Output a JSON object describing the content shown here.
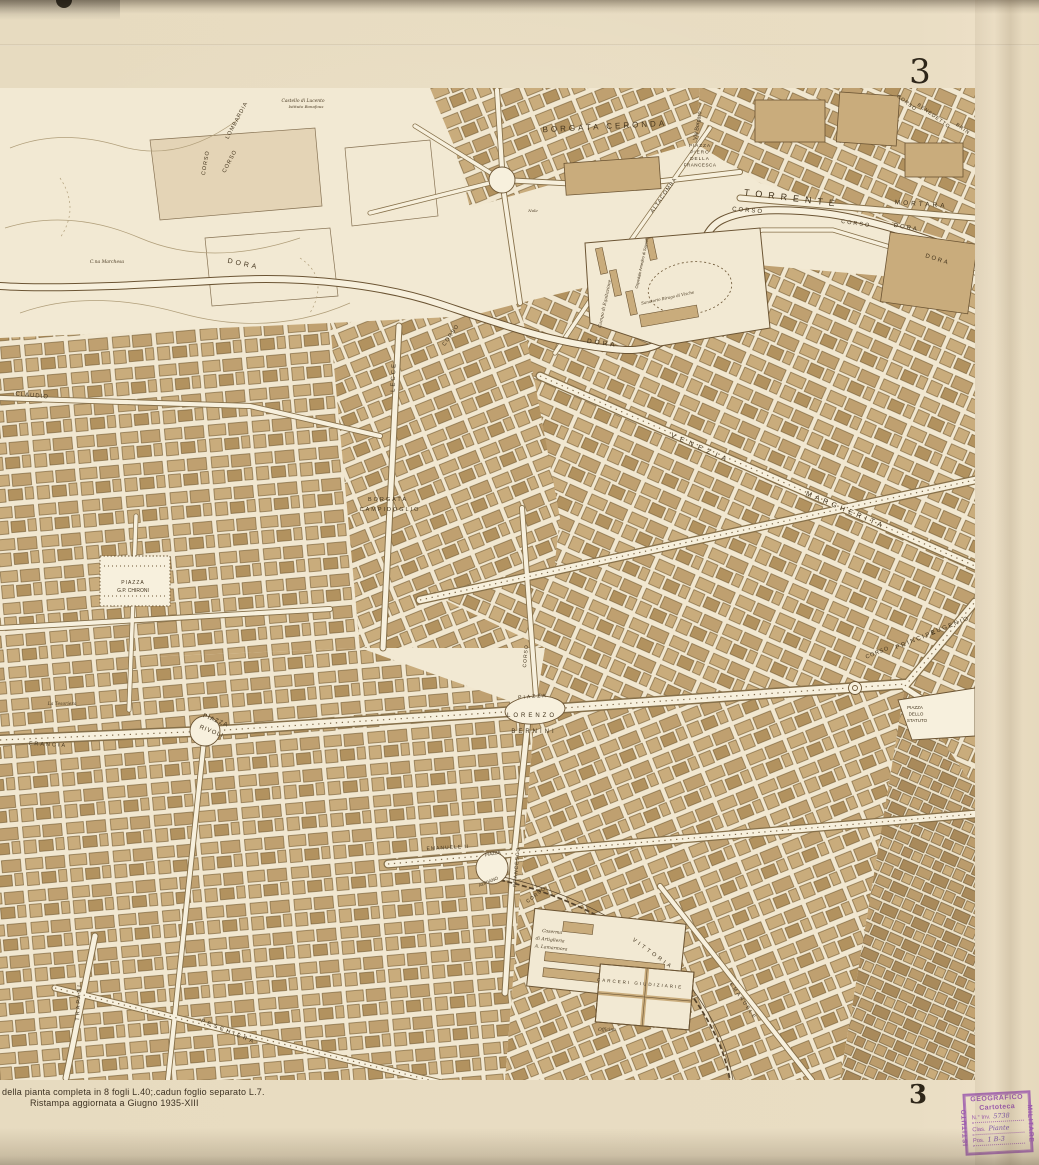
{
  "sheet": {
    "number_top": "3",
    "number_bottom": "3",
    "imprint_line1": "della pianta completa in 8 fogli L.40;.cadun foglio separato L.7.",
    "imprint_line2": "Ristampa aggiornata a Giugno 1935-XIII"
  },
  "stamp": {
    "org_top": "GEOGRAFICO",
    "org_left": "ISTITUTO",
    "org_right": "MILITARE",
    "title": "Cartoteca",
    "fields": [
      {
        "label": "N.° Inv.",
        "value": "5738"
      },
      {
        "label": "Clas.",
        "value": "Piante"
      },
      {
        "label": "Pos.",
        "value": "1 B-3"
      }
    ],
    "color": "#9b59ad"
  },
  "colors": {
    "paper": "#e8dcc2",
    "map_background": "#f2e9d3",
    "building_tan": "#c9ac7c",
    "building_dark": "#b2925f",
    "line_brown": "#6b5433",
    "label_ink": "#42331c",
    "stamp_purple": "#9b59ad"
  },
  "map": {
    "labels": [
      {
        "t": "BORGATA  CERONDA",
        "x": 605,
        "y": 41,
        "rot": -3,
        "s": 8,
        "ls": 3
      },
      {
        "t": "Via Borgaro",
        "x": 699,
        "y": 38,
        "rot": -80,
        "s": 5.5
      },
      {
        "t": "PIAZZA",
        "x": 700,
        "y": 59,
        "s": 4.6,
        "ls": 1
      },
      {
        "t": "PIERO",
        "x": 700,
        "y": 65.5,
        "s": 4.6,
        "ls": 1
      },
      {
        "t": "DELLA",
        "x": 700,
        "y": 72,
        "s": 4.6,
        "ls": 1
      },
      {
        "t": "FRANCESCA",
        "x": 700,
        "y": 78.5,
        "s": 4.6,
        "ls": 0.5
      },
      {
        "t": "TORRENTE",
        "x": 792,
        "y": 113,
        "rot": 7,
        "s": 9,
        "ls": 6
      },
      {
        "t": "CORSO",
        "x": 748,
        "y": 124,
        "rot": 5,
        "s": 6,
        "ls": 2
      },
      {
        "t": "MORTARA",
        "x": 921,
        "y": 118,
        "rot": 4,
        "s": 6.5,
        "ls": 3
      },
      {
        "t": "CORSO",
        "x": 856,
        "y": 137,
        "rot": 8,
        "s": 5.5,
        "ls": 2
      },
      {
        "t": "DORA",
        "x": 906,
        "y": 141,
        "rot": 10,
        "s": 6,
        "ls": 2
      },
      {
        "t": "DORA",
        "x": 937,
        "y": 173,
        "rot": 18,
        "s": 6,
        "ls": 2
      },
      {
        "t": "CORSO",
        "x": 906,
        "y": 16,
        "rot": 38,
        "s": 5,
        "ls": 1
      },
      {
        "t": "BENEDETTO",
        "x": 933,
        "y": 29,
        "rot": 36,
        "s": 5,
        "ls": 1
      },
      {
        "t": "BRIN",
        "x": 962,
        "y": 42,
        "rot": 36,
        "s": 5,
        "ls": 1
      },
      {
        "t": "LOMBARDIA",
        "x": 238,
        "y": 33,
        "rot": -62,
        "s": 5.5,
        "ls": 1
      },
      {
        "t": "CORSO",
        "x": 231,
        "y": 74,
        "rot": -62,
        "s": 5.5,
        "ls": 1
      },
      {
        "t": "CORSO",
        "x": 207,
        "y": 75,
        "rot": -80,
        "s": 5.5,
        "ls": 1
      },
      {
        "t": "Castello di Lucento",
        "x": 303,
        "y": 14,
        "s": 4.4,
        "i": 1
      },
      {
        "t": "Istituto Bonafous",
        "x": 306,
        "y": 20,
        "s": 4,
        "i": 1
      },
      {
        "t": "DORA",
        "x": 243,
        "y": 178,
        "rot": 12,
        "s": 7,
        "ls": 3
      },
      {
        "t": "C.na Marchesa",
        "x": 107,
        "y": 175,
        "s": 4.5,
        "i": 1
      },
      {
        "t": "CLAUDIO",
        "x": 32,
        "y": 309,
        "rot": 5,
        "s": 6,
        "ls": 1
      },
      {
        "t": "LECCE",
        "x": 395,
        "y": 289,
        "rot": -88,
        "s": 6,
        "ls": 2
      },
      {
        "t": "ALTACOMBA",
        "x": 665,
        "y": 108,
        "rot": -55,
        "s": 5.5,
        "ls": 1
      },
      {
        "t": "Nole",
        "x": 533,
        "y": 124,
        "s": 4,
        "i": 1
      },
      {
        "t": "Campo di Equitazione",
        "x": 606,
        "y": 216,
        "rot": -78,
        "s": 4.4,
        "i": 1
      },
      {
        "t": "Ospedale Amedeo di Savoia",
        "x": 643,
        "y": 176,
        "rot": -78,
        "s": 4
      },
      {
        "t": "Sanatorio Birago di Vische",
        "x": 668,
        "y": 211,
        "rot": -12,
        "s": 4,
        "i": 1
      },
      {
        "t": "DORA",
        "x": 602,
        "y": 257,
        "rot": 8,
        "s": 6.5,
        "ls": 3
      },
      {
        "t": "CORSO",
        "x": 452,
        "y": 248,
        "rot": -55,
        "s": 5.5,
        "ls": 1
      },
      {
        "t": "BORGATA",
        "x": 388,
        "y": 413,
        "s": 5.5,
        "ls": 2
      },
      {
        "t": "CAMPIDOGLIO",
        "x": 390,
        "y": 423,
        "s": 5.5,
        "ls": 2
      },
      {
        "t": "VENEZIA",
        "x": 700,
        "y": 362,
        "rot": 24,
        "s": 7,
        "ls": 5
      },
      {
        "t": "MARGHERITA",
        "x": 845,
        "y": 424,
        "rot": 23,
        "s": 7,
        "ls": 4
      },
      {
        "t": "PIAZZA",
        "x": 133,
        "y": 496,
        "s": 5,
        "ls": 1
      },
      {
        "t": "G.P. CHIRONI",
        "x": 133,
        "y": 504,
        "s": 5
      },
      {
        "t": "PIAZZA",
        "x": 215,
        "y": 634,
        "rot": 22,
        "s": 6,
        "ls": 1
      },
      {
        "t": "RIVOLI",
        "x": 211,
        "y": 645,
        "rot": 22,
        "s": 6,
        "ls": 1
      },
      {
        "t": "FRANCIA",
        "x": 48,
        "y": 658,
        "rot": 3,
        "s": 5.5,
        "ls": 2
      },
      {
        "t": "La Tesoriera",
        "x": 62,
        "y": 617,
        "s": 4.5,
        "i": 1
      },
      {
        "t": "PIAZZA",
        "x": 533,
        "y": 610,
        "rot": -4,
        "s": 5,
        "ls": 2
      },
      {
        "t": "LORENZO",
        "x": 532,
        "y": 629,
        "s": 6,
        "ls": 3
      },
      {
        "t": "BERNINI",
        "x": 534,
        "y": 645,
        "s": 6,
        "ls": 3
      },
      {
        "t": "CORSO",
        "x": 527,
        "y": 568,
        "rot": -85,
        "s": 5,
        "ls": 1
      },
      {
        "t": "CORSO",
        "x": 878,
        "y": 566,
        "rot": -22,
        "s": 5.5,
        "ls": 1
      },
      {
        "t": "PRINCIPE",
        "x": 917,
        "y": 553,
        "rot": -22,
        "s": 6,
        "ls": 2
      },
      {
        "t": "EUGENIO",
        "x": 951,
        "y": 539,
        "rot": -22,
        "s": 6,
        "ls": 2
      },
      {
        "t": "PIAZZA",
        "x": 915,
        "y": 621,
        "s": 4.5
      },
      {
        "t": "DELLO",
        "x": 916,
        "y": 627.5,
        "s": 4.5
      },
      {
        "t": "STATUTO",
        "x": 917,
        "y": 634,
        "s": 4.5
      },
      {
        "t": "EMANUELE II",
        "x": 448,
        "y": 761,
        "rot": -3,
        "s": 5,
        "ls": 1
      },
      {
        "t": "PIAZZA",
        "x": 493,
        "y": 767,
        "rot": -12,
        "s": 4.5
      },
      {
        "t": "ADRIANO",
        "x": 489,
        "y": 795,
        "rot": -22,
        "s": 4.5
      },
      {
        "t": "FRANCESCO",
        "x": 518,
        "y": 779,
        "rot": -85,
        "s": 5,
        "ls": 1
      },
      {
        "t": "CORSO",
        "x": 537,
        "y": 808,
        "rot": -38,
        "s": 5,
        "ls": 1
      },
      {
        "t": "Caserma",
        "x": 552,
        "y": 845,
        "rot": 6,
        "s": 4.5,
        "i": 1
      },
      {
        "t": "di Artiglieria",
        "x": 550,
        "y": 853,
        "rot": 6,
        "s": 4.5,
        "i": 1
      },
      {
        "t": "A. Lamarmora",
        "x": 551,
        "y": 861,
        "rot": 6,
        "s": 4.5,
        "i": 1
      },
      {
        "t": "VITTORIA",
        "x": 652,
        "y": 867,
        "rot": 36,
        "s": 5.5,
        "ls": 3
      },
      {
        "t": "CARCERI  GIUDIZIARIE",
        "x": 640,
        "y": 897,
        "rot": 5,
        "s": 4.5,
        "ls": 2
      },
      {
        "t": "Officine",
        "x": 607,
        "y": 943,
        "s": 4.5,
        "i": 1
      },
      {
        "t": "EMANUELE",
        "x": 742,
        "y": 914,
        "rot": 55,
        "s": 5,
        "ls": 2
      },
      {
        "t": "PESCHIERA",
        "x": 228,
        "y": 945,
        "rot": 22,
        "s": 5.5,
        "ls": 3
      },
      {
        "t": "TRAPANI",
        "x": 80,
        "y": 914,
        "rot": -87,
        "s": 5.5,
        "ls": 2
      }
    ]
  }
}
